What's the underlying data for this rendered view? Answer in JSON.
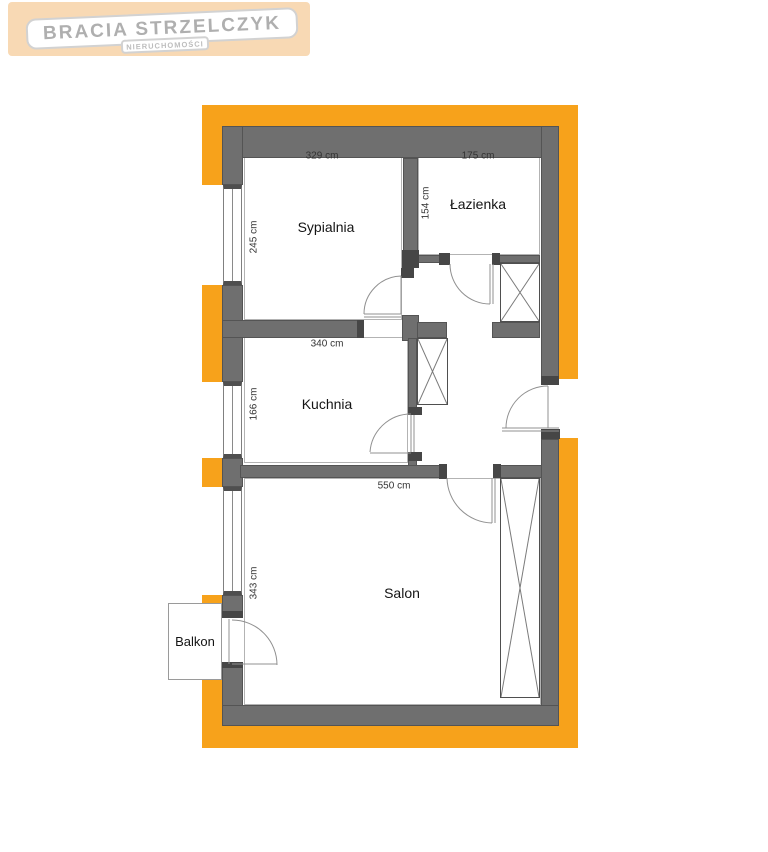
{
  "logo": {
    "title": "BRACIA STRZELCZYK",
    "subtitle": "NIERUCHOMOŚCI"
  },
  "colors": {
    "accent": "#F7A21B",
    "wall": "#6F6F6F",
    "logo_bg": "#F8D9B4",
    "logo_text": "#AFAFAF"
  },
  "plan": {
    "rooms": [
      {
        "name": "Sypialnia",
        "width": "329 cm",
        "depth": "245 cm"
      },
      {
        "name": "Łazienka",
        "width": "175 cm",
        "depth": "154 cm"
      },
      {
        "name": "Kuchnia",
        "width": "340 cm",
        "depth": "166 cm"
      },
      {
        "name": "Salon",
        "width": "550 cm",
        "depth": "343 cm"
      },
      {
        "name": "Balkon"
      }
    ]
  }
}
